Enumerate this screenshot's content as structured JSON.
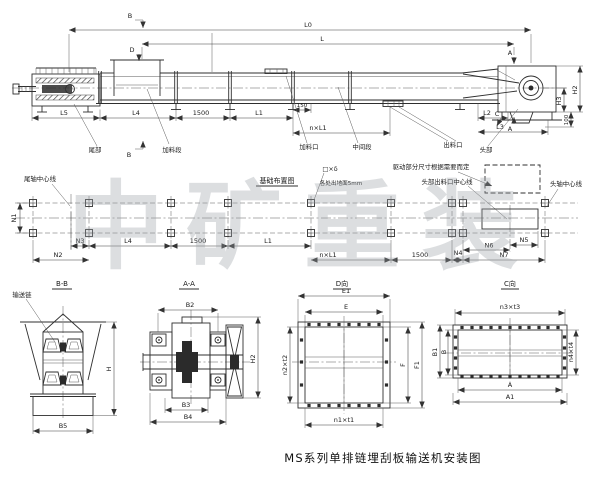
{
  "page": {
    "title": "MS系列单排链埋刮板输送机安装图",
    "watermark": "中矿重装"
  },
  "side_view": {
    "marks": {
      "b_top": "B",
      "b_bottom": "B",
      "d": "D",
      "a_top": "A",
      "a_bottom": "A",
      "c": "C"
    },
    "dims": {
      "l0": "L0",
      "l": "L",
      "l5": "L5",
      "l4": "L4",
      "seg1500": "1500",
      "l1": "L1",
      "off150": "150",
      "n_l1": "n×L1",
      "l2": "L2",
      "l3": "L3",
      "h2": "H2",
      "h3": "H3",
      "base100": "100"
    },
    "labels": {
      "tail": "尾部",
      "feed_section": "加料段",
      "feed_inlet": "加料口",
      "middle_section": "中间段",
      "discharge_outlet": "出料口",
      "head": "头部"
    }
  },
  "plan_view": {
    "title": "基础布置图",
    "labels": {
      "tail_axis": "尾轴中心线",
      "anchor_plate": "□×δ",
      "ground_note": "各处出地面5mm",
      "drive_note": "驱动部分尺寸根据需要而定",
      "head_outlet_axis": "头部出料口中心线",
      "head_axis": "头轴中心线"
    },
    "dims": {
      "n1": "N1",
      "n2": "N2",
      "n3": "N3",
      "l4": "L4",
      "seg1500a": "1500",
      "l1": "L1",
      "n_l1": "n×L1",
      "seg1500b": "1500",
      "n4": "N4",
      "n5": "N5",
      "n6": "N6",
      "n7": "N7"
    }
  },
  "section_bb": {
    "title": "B-B",
    "labels": {
      "chain": "输送链"
    },
    "dims": {
      "h": "H",
      "b5": "B5"
    }
  },
  "section_aa": {
    "title": "A-A",
    "dims": {
      "b2": "B2",
      "h2": "H2",
      "b3": "B3",
      "b4": "B4"
    }
  },
  "view_d": {
    "title": "D向",
    "dims": {
      "e1": "E1",
      "e": "E",
      "f": "F",
      "f1": "F1",
      "n2t2": "n2×t2",
      "n1t1": "n1×t1"
    }
  },
  "view_c": {
    "title": "C向",
    "dims": {
      "n3t3": "n3×t3",
      "n4t4": "n4×t4",
      "b1": "B1",
      "b": "B",
      "a": "A",
      "a1": "A1"
    }
  }
}
